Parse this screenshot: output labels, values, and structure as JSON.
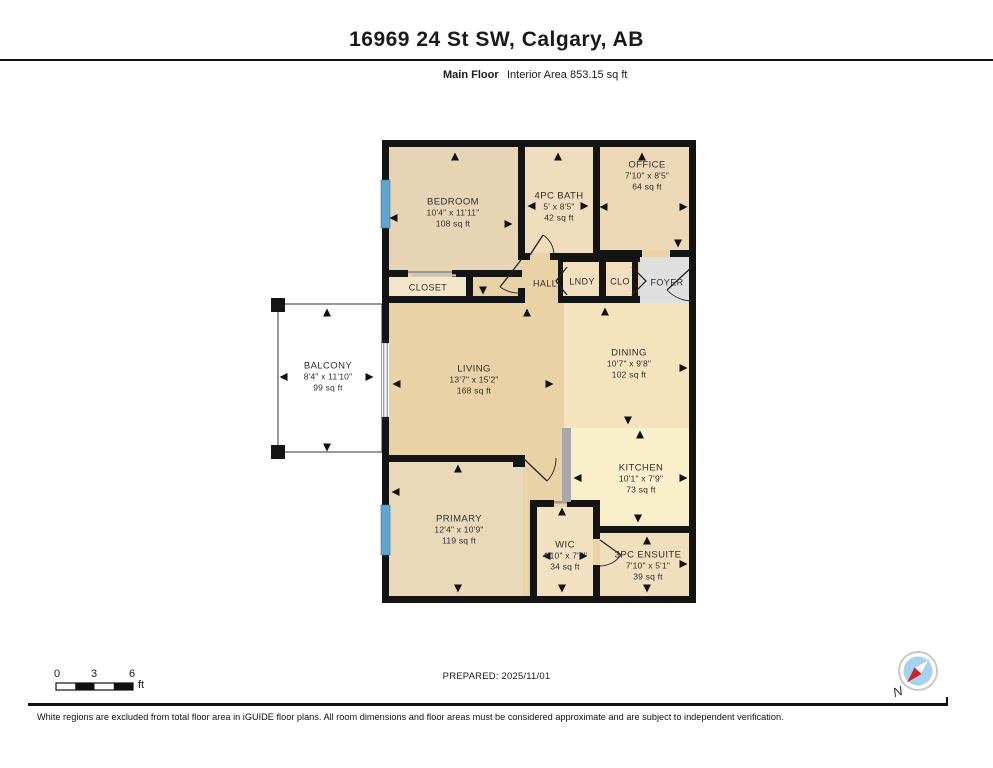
{
  "header": {
    "title": "16969 24 St SW, Calgary, AB",
    "floor_label": "Main Floor",
    "area_label": "Interior Area 853.15 sq ft"
  },
  "plan": {
    "rooms": [
      {
        "name": "BEDROOM",
        "dims": "10'4\" x 11'11\"",
        "area": "108 sq ft"
      },
      {
        "name": "4PC BATH",
        "dims": "5' x 8'5\"",
        "area": "42 sq ft"
      },
      {
        "name": "OFFICE",
        "dims": "7'10\" x 8'5\"",
        "area": "64 sq ft"
      },
      {
        "name": "CLOSET"
      },
      {
        "name": "HALL"
      },
      {
        "name": "LNDY"
      },
      {
        "name": "CLO"
      },
      {
        "name": "FOYER"
      },
      {
        "name": "BALCONY",
        "dims": "8'4\" x 11'10\"",
        "area": "99 sq ft"
      },
      {
        "name": "LIVING",
        "dims": "13'7\" x 15'2\"",
        "area": "168 sq ft"
      },
      {
        "name": "DINING",
        "dims": "10'7\" x 9'8\"",
        "area": "102 sq ft"
      },
      {
        "name": "KITCHEN",
        "dims": "10'1\" x 7'9\"",
        "area": "73 sq ft"
      },
      {
        "name": "PRIMARY",
        "dims": "12'4\" x 10'9\"",
        "area": "119 sq ft"
      },
      {
        "name": "WIC",
        "dims": "4'10\" x 7'3\"",
        "area": "34 sq ft"
      },
      {
        "name": "3PC ENSUITE",
        "dims": "7'10\" x 5'1\"",
        "area": "39 sq ft"
      }
    ]
  },
  "scale_bar": {
    "tick_0": "0",
    "tick_3": "3",
    "tick_6": "6",
    "unit": "ft"
  },
  "compass": {
    "label": "N"
  },
  "footer": {
    "prepared": "PREPARED: 2025/11/01",
    "disclaimer": "White regions are excluded from total floor area in iGUIDE floor plans. All room dimensions and floor areas must be considered approximate and are subject to independent verification."
  },
  "colors": {
    "wall_black": "#141414",
    "window_blue": "#5fa5cd",
    "foyer_gray": "#dfdfdf",
    "living_tan": "#e9d2a6",
    "kitchen_cream": "#f9efca",
    "compass_red": "#cc2229",
    "compass_blue": "#a7d1ec"
  }
}
